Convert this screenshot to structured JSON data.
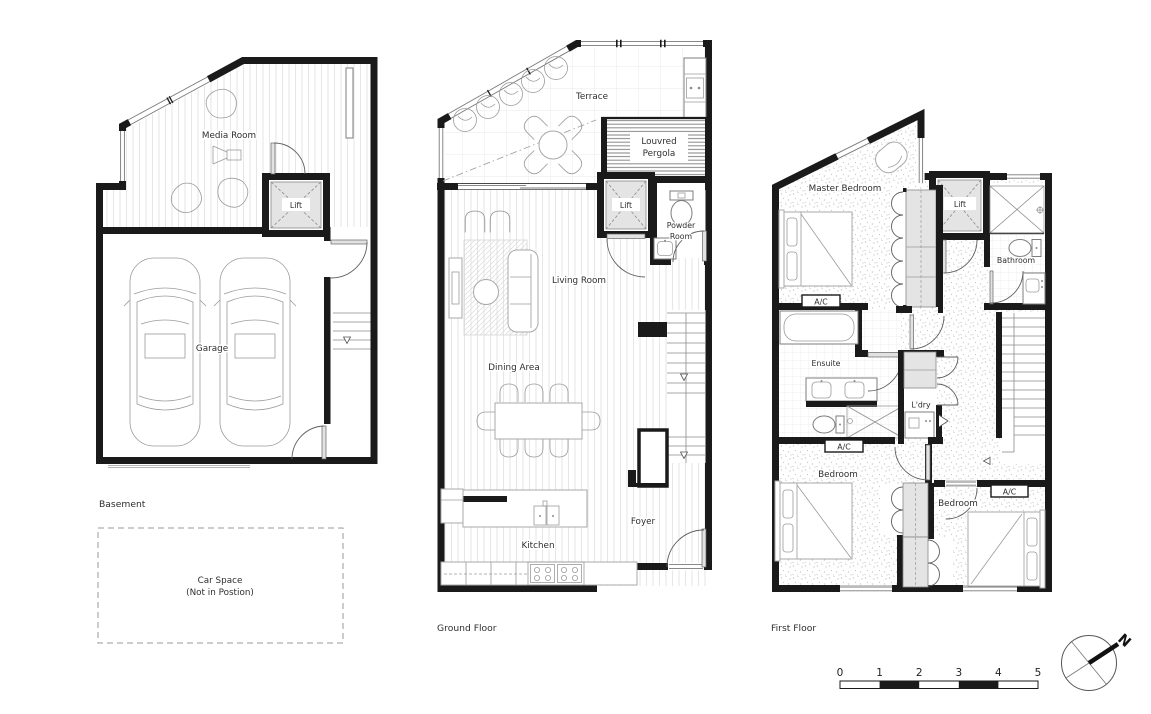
{
  "colors": {
    "wall": "#1a1a1a",
    "line": "#8a8a8a",
    "furniture": "#a8a8a8",
    "fill_gray": "#e4e4e4",
    "background": "#ffffff"
  },
  "plans": {
    "basement": {
      "title": "Basement",
      "rooms": {
        "media_room": "Media Room",
        "lift": "Lift",
        "garage": "Garage"
      },
      "car_space": {
        "line1": "Car Space",
        "line2": "(Not in Postion)"
      }
    },
    "ground": {
      "title": "Ground Floor",
      "rooms": {
        "terrace": "Terrace",
        "pergola_line1": "Louvred",
        "pergola_line2": "Pergola",
        "lift": "Lift",
        "powder_line1": "Powder",
        "powder_line2": "Room",
        "living": "Living Room",
        "dining": "Dining Area",
        "kitchen": "Kitchen",
        "foyer": "Foyer"
      }
    },
    "first": {
      "title": "First Floor",
      "rooms": {
        "master": "Master Bedroom",
        "lift": "Lift",
        "bathroom": "Bathroom",
        "ensuite": "Ensuite",
        "laundry": "L'dry",
        "bedroom_left": "Bedroom",
        "bedroom_right": "Bedroom",
        "ac": "A/C"
      }
    }
  },
  "scale_bar": {
    "labels": [
      "0",
      "1",
      "2",
      "3",
      "4",
      "5"
    ]
  },
  "compass": {
    "north": "N"
  }
}
